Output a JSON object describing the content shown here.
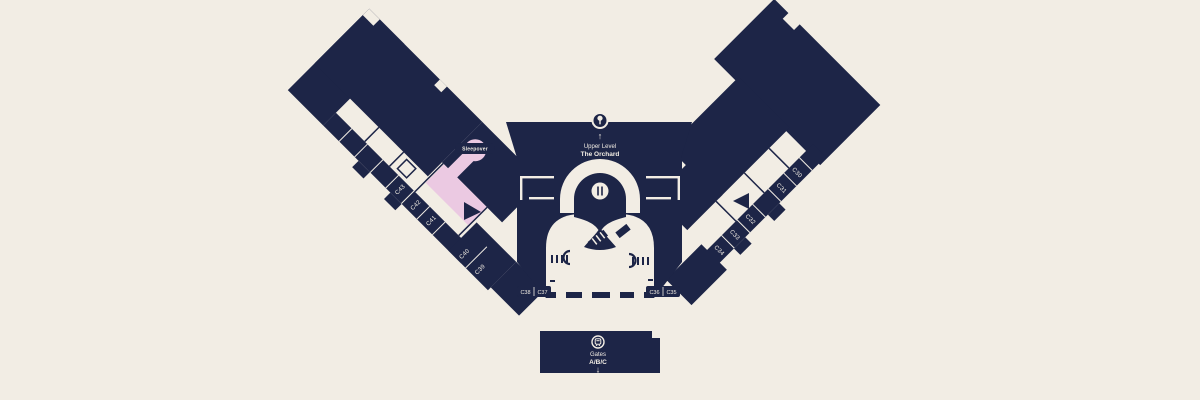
{
  "colors": {
    "background": "#F2EDE4",
    "terminal_navy": "#1D2547",
    "highlight_pink": "#EBC9E2"
  },
  "upper_level": {
    "arrow": "↑",
    "line1": "Upper Level",
    "line2": "The Orchard"
  },
  "sleepover": {
    "label": "Sleepover"
  },
  "gates": {
    "left_wing": [
      "C43",
      "C42",
      "C41"
    ],
    "left_connector": [
      "C40",
      "C39"
    ],
    "bottom_left": [
      "C38",
      "C37"
    ],
    "bottom_right": [
      "C36",
      "C35"
    ],
    "right_wing_lower": [
      "C34",
      "C33",
      "C32"
    ],
    "right_wing_upper": [
      "C31",
      "C30"
    ]
  },
  "transit": {
    "line1": "Gates",
    "line2": "A/B/C",
    "arrow": "↓"
  }
}
